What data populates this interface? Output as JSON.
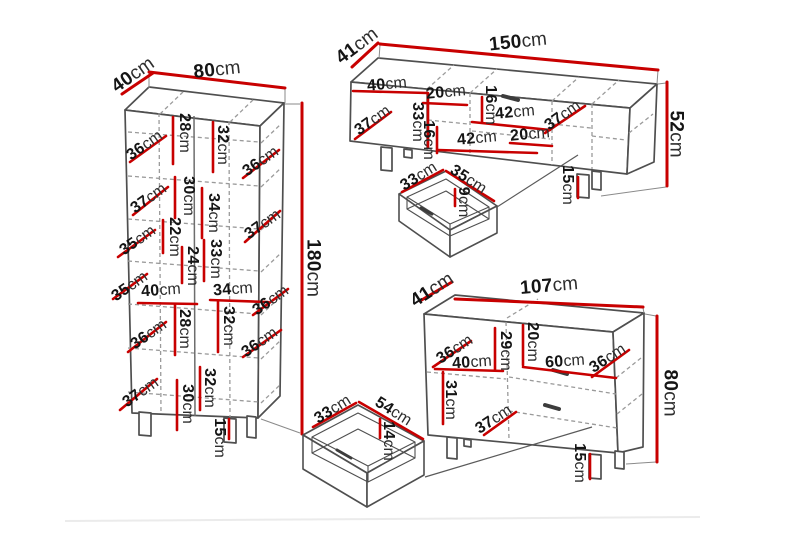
{
  "colors": {
    "dimension_red": "#c80000",
    "edge_gray": "#4f4f4f"
  },
  "cabinet": {
    "depth": {
      "v": "40",
      "u": "cm"
    },
    "width": {
      "v": "80",
      "u": "cm"
    },
    "height": {
      "v": "180",
      "u": "cm"
    },
    "leg": {
      "v": "15",
      "u": "cm"
    },
    "interior": [
      {
        "v": "36",
        "u": "cm"
      },
      {
        "v": "28",
        "u": "cm"
      },
      {
        "v": "32",
        "u": "cm"
      },
      {
        "v": "36",
        "u": "cm"
      },
      {
        "v": "37",
        "u": "cm"
      },
      {
        "v": "30",
        "u": "cm"
      },
      {
        "v": "34",
        "u": "cm"
      },
      {
        "v": "37",
        "u": "cm"
      },
      {
        "v": "35",
        "u": "cm"
      },
      {
        "v": "22",
        "u": "cm"
      },
      {
        "v": "33",
        "u": "cm"
      },
      {
        "v": "24",
        "u": "cm"
      },
      {
        "v": "35",
        "u": "cm"
      },
      {
        "v": "40",
        "u": "cm"
      },
      {
        "v": "34",
        "u": "cm"
      },
      {
        "v": "36",
        "u": "cm"
      },
      {
        "v": "28",
        "u": "cm"
      },
      {
        "v": "32",
        "u": "cm"
      },
      {
        "v": "36",
        "u": "cm"
      },
      {
        "v": "36",
        "u": "cm"
      },
      {
        "v": "37",
        "u": "cm"
      },
      {
        "v": "30",
        "u": "cm"
      },
      {
        "v": "32",
        "u": "cm"
      }
    ]
  },
  "tv_stand": {
    "depth": {
      "v": "41",
      "u": "cm"
    },
    "width": {
      "v": "150",
      "u": "cm"
    },
    "height": {
      "v": "52",
      "u": "cm"
    },
    "leg": {
      "v": "15",
      "u": "cm"
    },
    "interior": [
      {
        "v": "40",
        "u": "cm"
      },
      {
        "v": "20",
        "u": "cm"
      },
      {
        "v": "16",
        "u": "cm"
      },
      {
        "v": "42",
        "u": "cm"
      },
      {
        "v": "37",
        "u": "cm"
      },
      {
        "v": "16",
        "u": "cm"
      },
      {
        "v": "42",
        "u": "cm"
      },
      {
        "v": "20",
        "u": "cm"
      },
      {
        "v": "33",
        "u": "cm"
      },
      {
        "v": "37",
        "u": "cm"
      }
    ],
    "drawer": {
      "width": {
        "v": "33",
        "u": "cm"
      },
      "depth": {
        "v": "35",
        "u": "cm"
      },
      "height": {
        "v": "9",
        "u": "cm"
      }
    }
  },
  "chest": {
    "depth": {
      "v": "41",
      "u": "cm"
    },
    "width": {
      "v": "107",
      "u": "cm"
    },
    "height": {
      "v": "80",
      "u": "cm"
    },
    "leg": {
      "v": "15",
      "u": "cm"
    },
    "interior": [
      {
        "v": "36",
        "u": "cm"
      },
      {
        "v": "40",
        "u": "cm"
      },
      {
        "v": "29",
        "u": "cm"
      },
      {
        "v": "20",
        "u": "cm"
      },
      {
        "v": "60",
        "u": "cm"
      },
      {
        "v": "36",
        "u": "cm"
      },
      {
        "v": "31",
        "u": "cm"
      },
      {
        "v": "37",
        "u": "cm"
      }
    ],
    "drawer": {
      "width": {
        "v": "33",
        "u": "cm"
      },
      "depth": {
        "v": "54",
        "u": "cm"
      },
      "height": {
        "v": "14",
        "u": "cm"
      }
    }
  }
}
